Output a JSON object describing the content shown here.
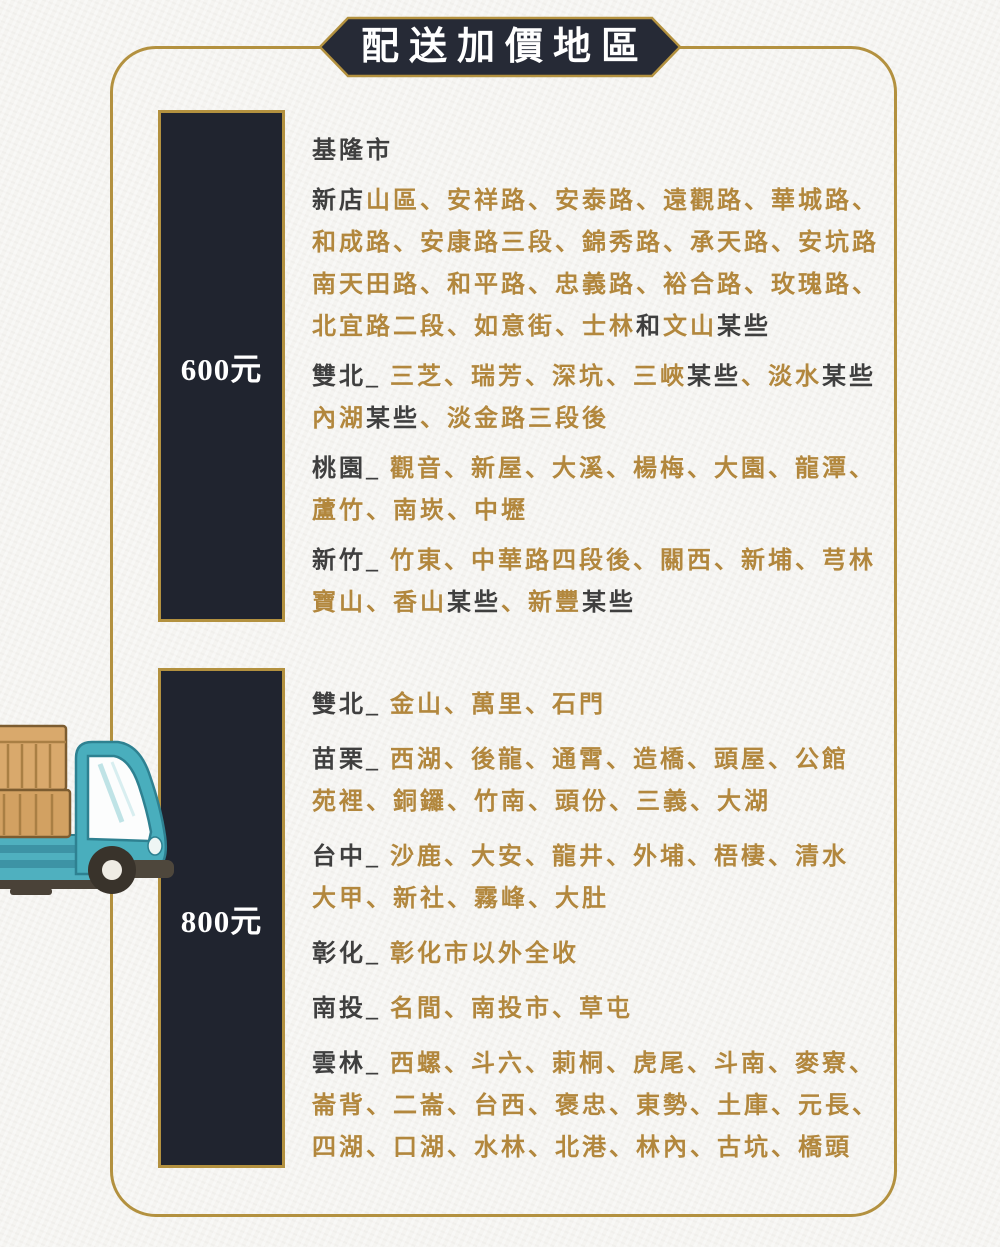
{
  "title": {
    "text": "配送加價地區"
  },
  "colors": {
    "gold_text": "#b2873d",
    "dark_text": "#3f3f3f",
    "gold_border": "#b3913f",
    "bar_bg": "#20242f",
    "banner_bg": "#262a36",
    "page_bg": "#f5f4f1",
    "white": "#ffffff"
  },
  "icons": {
    "truck": "delivery-truck-illustration"
  },
  "sections": [
    {
      "price": "600元",
      "paragraphs": [
        [
          [
            {
              "t": "基隆市",
              "c": "d"
            }
          ]
        ],
        [
          [
            {
              "t": "新店",
              "c": "d"
            },
            {
              "t": "山區、安祥路、安泰路、遠觀路、華城路、",
              "c": "g"
            }
          ],
          [
            {
              "t": "和成路、安康路三段、錦秀路、承天路、安坑路",
              "c": "g"
            }
          ],
          [
            {
              "t": "南天田路、和平路、忠義路、裕合路、玫瑰路、",
              "c": "g"
            }
          ],
          [
            {
              "t": "北宜路二段、如意街、士林",
              "c": "g"
            },
            {
              "t": "和",
              "c": "d"
            },
            {
              "t": "文山",
              "c": "g"
            },
            {
              "t": "某些",
              "c": "d"
            }
          ]
        ],
        [
          [
            {
              "t": "雙北_ ",
              "c": "d"
            },
            {
              "t": "三芝、瑞芳、深坑、三峽",
              "c": "g"
            },
            {
              "t": "某些",
              "c": "d"
            },
            {
              "t": "、淡水",
              "c": "g"
            },
            {
              "t": "某些",
              "c": "d"
            }
          ],
          [
            {
              "t": "內湖",
              "c": "g"
            },
            {
              "t": "某些",
              "c": "d"
            },
            {
              "t": "、淡金路三段後",
              "c": "g"
            }
          ]
        ],
        [
          [
            {
              "t": "桃園_ ",
              "c": "d"
            },
            {
              "t": "觀音、新屋、大溪、楊梅、大園、龍潭、",
              "c": "g"
            }
          ],
          [
            {
              "t": "蘆竹、南崁、中壢",
              "c": "g"
            }
          ]
        ],
        [
          [
            {
              "t": "新竹_ ",
              "c": "d"
            },
            {
              "t": "竹東、中華路四段後、關西、新埔、芎林",
              "c": "g"
            }
          ],
          [
            {
              "t": "寶山、香山",
              "c": "g"
            },
            {
              "t": "某些",
              "c": "d"
            },
            {
              "t": "、新豐",
              "c": "g"
            },
            {
              "t": "某些",
              "c": "d"
            }
          ]
        ]
      ]
    },
    {
      "price": "800元",
      "paragraphs": [
        [
          [
            {
              "t": "雙北_ ",
              "c": "d"
            },
            {
              "t": "金山、萬里、石門",
              "c": "g"
            }
          ]
        ],
        [
          [
            {
              "t": "苗栗_ ",
              "c": "d"
            },
            {
              "t": "西湖、後龍、通霄、造橋、頭屋、公館",
              "c": "g"
            }
          ],
          [
            {
              "t": "苑裡、銅鑼、竹南、頭份、三義、大湖",
              "c": "g"
            }
          ]
        ],
        [
          [
            {
              "t": "台中_ ",
              "c": "d"
            },
            {
              "t": "沙鹿、大安、龍井、外埔、梧棲、清水",
              "c": "g"
            }
          ],
          [
            {
              "t": "大甲、新社、霧峰、大肚",
              "c": "g"
            }
          ]
        ],
        [
          [
            {
              "t": "彰化_ ",
              "c": "d"
            },
            {
              "t": "彰化市以外全收",
              "c": "g"
            }
          ]
        ],
        [
          [
            {
              "t": "南投_ ",
              "c": "d"
            },
            {
              "t": "名間、南投市、草屯",
              "c": "g"
            }
          ]
        ],
        [
          [
            {
              "t": "雲林_ ",
              "c": "d"
            },
            {
              "t": "西螺、斗六、莿桐、虎尾、斗南、麥寮、",
              "c": "g"
            }
          ],
          [
            {
              "t": "崙背、二崙、台西、褒忠、東勢、土庫、元長、",
              "c": "g"
            }
          ],
          [
            {
              "t": "四湖、口湖、水林、北港、林內、古坑、橋頭",
              "c": "g"
            }
          ]
        ]
      ]
    }
  ]
}
